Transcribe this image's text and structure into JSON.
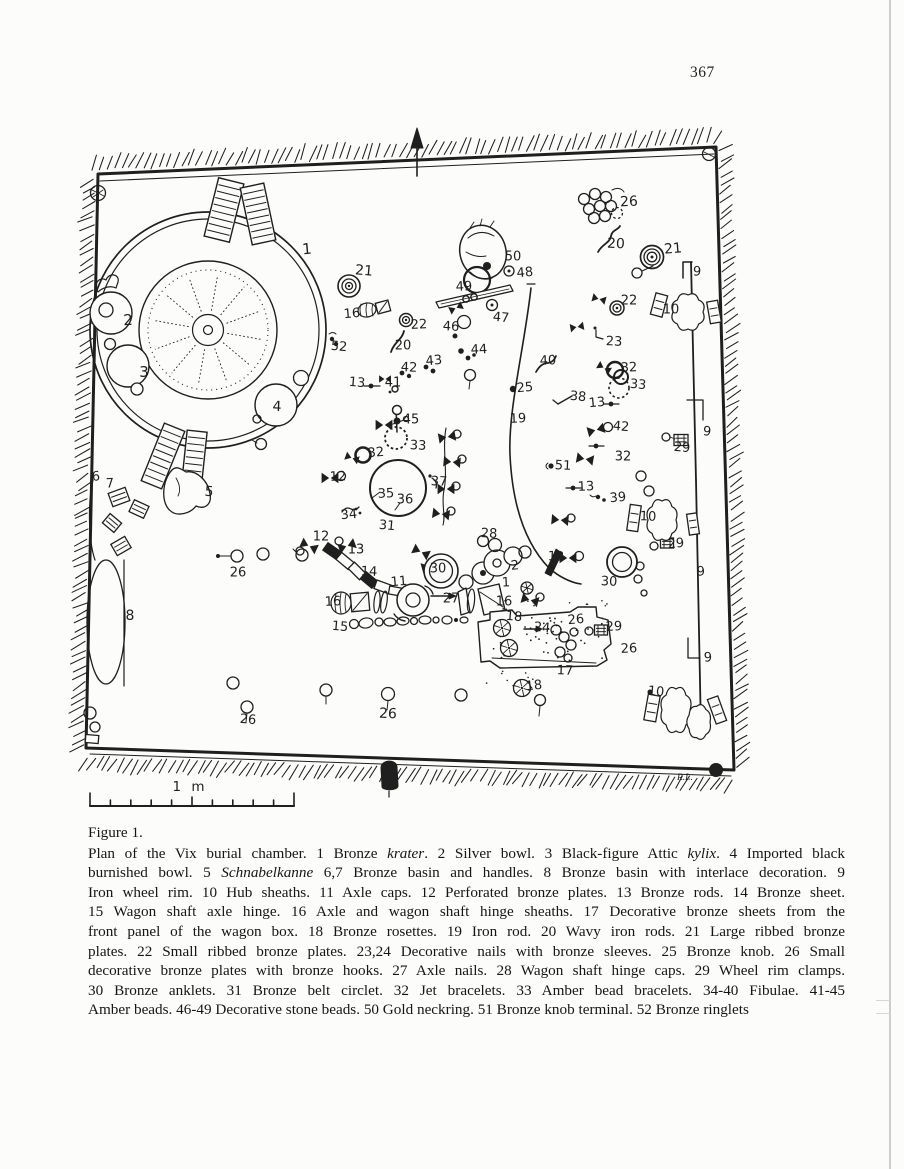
{
  "page": {
    "number": "367",
    "figure_label": "Figure 1.",
    "scale_label": "1 m",
    "signature": "R.L."
  },
  "colors": {
    "ink": "#1f1f1f",
    "paper": "#fcfcfa"
  },
  "caption": {
    "lines": [
      [
        {
          "t": "Plan of the Vix burial chamber. 1 Bronze "
        },
        {
          "t": "krater",
          "i": true
        },
        {
          "t": ". 2 Silver bowl. 3 Black-figure Attic "
        },
        {
          "t": "kylix",
          "i": true
        },
        {
          "t": ". 4 Imported black"
        }
      ],
      [
        {
          "t": "burnished bowl. 5 "
        },
        {
          "t": "Schnabelkanne",
          "i": true
        },
        {
          "t": " 6,7 Bronze basin and handles. 8 Bronze basin with interlace decoration. 9"
        }
      ],
      [
        {
          "t": "Iron wheel rim. 10 Hub sheaths. 11 Axle caps. 12 Perforated bronze plates. 13 Bronze rods. 14 Bronze sheet."
        }
      ],
      [
        {
          "t": "15 Wagon shaft axle hinge. 16 Axle and wagon shaft hinge sheaths. 17 Decorative bronze sheets from the"
        }
      ],
      [
        {
          "t": "front panel of the wagon box. 18 Bronze rosettes. 19 Iron rod. 20 Wavy iron rods. 21 Large ribbed bronze"
        }
      ],
      [
        {
          "t": "plates. 22 Small ribbed bronze plates. 23,24 Decorative nails with bronze sleeves. 25 Bronze knob. 26 Small"
        }
      ],
      [
        {
          "t": "decorative bronze plates with bronze hooks. 27 Axle nails. 28 Wagon shaft hinge caps. 29 Wheel rim clamps."
        }
      ],
      [
        {
          "t": "30 Bronze anklets. 31 Bronze belt circlet. 32 Jet bracelets. 33 Amber bead bracelets. 34-40 Fibulae. 41-45"
        }
      ],
      [
        {
          "t": "Amber beads. 46-49 Decorative stone beads. 50 Gold neckring. 51 Bronze knob terminal. 52 Bronze ringlets"
        }
      ]
    ]
  },
  "figure": {
    "labels": [
      {
        "t": "1",
        "x": 307,
        "y": 249,
        "s": 15
      },
      {
        "t": "2",
        "x": 128,
        "y": 320,
        "s": 15
      },
      {
        "t": "3",
        "x": 144,
        "y": 372,
        "s": 15
      },
      {
        "t": "4",
        "x": 277,
        "y": 407,
        "s": 14
      },
      {
        "t": "5",
        "x": 209,
        "y": 492,
        "s": 14
      },
      {
        "t": "6",
        "x": 96,
        "y": 477
      },
      {
        "t": "7",
        "x": 110,
        "y": 484
      },
      {
        "t": "8",
        "x": 130,
        "y": 616,
        "s": 14
      },
      {
        "t": "9",
        "x": 697,
        "y": 272
      },
      {
        "t": "9",
        "x": 707,
        "y": 432
      },
      {
        "t": "9",
        "x": 701,
        "y": 572
      },
      {
        "t": "9",
        "x": 708,
        "y": 658
      },
      {
        "t": "10",
        "x": 671,
        "y": 310
      },
      {
        "t": "10",
        "x": 648,
        "y": 517
      },
      {
        "t": "10",
        "x": 656,
        "y": 692
      },
      {
        "t": "11",
        "x": 399,
        "y": 582
      },
      {
        "t": "12",
        "x": 338,
        "y": 477
      },
      {
        "t": "12",
        "x": 321,
        "y": 537
      },
      {
        "t": "12",
        "x": 556,
        "y": 557
      },
      {
        "t": "13",
        "x": 357,
        "y": 383
      },
      {
        "t": "13",
        "x": 597,
        "y": 403
      },
      {
        "t": "13",
        "x": 586,
        "y": 487
      },
      {
        "t": "13",
        "x": 356,
        "y": 550
      },
      {
        "t": "14",
        "x": 369,
        "y": 572
      },
      {
        "t": "15",
        "x": 340,
        "y": 627
      },
      {
        "t": "16",
        "x": 352,
        "y": 314
      },
      {
        "t": "16",
        "x": 333,
        "y": 602
      },
      {
        "t": "16",
        "x": 504,
        "y": 602
      },
      {
        "t": "17",
        "x": 565,
        "y": 671
      },
      {
        "t": "18",
        "x": 514,
        "y": 617
      },
      {
        "t": "18",
        "x": 534,
        "y": 686
      },
      {
        "t": "19",
        "x": 518,
        "y": 419
      },
      {
        "t": "20",
        "x": 403,
        "y": 346
      },
      {
        "t": "20",
        "x": 616,
        "y": 244,
        "s": 14
      },
      {
        "t": "21",
        "x": 364,
        "y": 271,
        "s": 14
      },
      {
        "t": "21",
        "x": 673,
        "y": 249,
        "s": 14
      },
      {
        "t": "22",
        "x": 419,
        "y": 325
      },
      {
        "t": "22",
        "x": 629,
        "y": 301
      },
      {
        "t": "23",
        "x": 614,
        "y": 342
      },
      {
        "t": "24",
        "x": 542,
        "y": 628
      },
      {
        "t": "25",
        "x": 525,
        "y": 388
      },
      {
        "t": "26",
        "x": 629,
        "y": 202,
        "s": 14
      },
      {
        "t": "26",
        "x": 238,
        "y": 573
      },
      {
        "t": "26",
        "x": 388,
        "y": 714,
        "s": 14
      },
      {
        "t": "26",
        "x": 248,
        "y": 720
      },
      {
        "t": "26",
        "x": 576,
        "y": 620
      },
      {
        "t": "26",
        "x": 629,
        "y": 649
      },
      {
        "t": "27",
        "x": 451,
        "y": 599
      },
      {
        "t": "28",
        "x": 489,
        "y": 534
      },
      {
        "t": "29",
        "x": 682,
        "y": 448
      },
      {
        "t": "29",
        "x": 676,
        "y": 544
      },
      {
        "t": "29",
        "x": 614,
        "y": 627
      },
      {
        "t": "30",
        "x": 438,
        "y": 569
      },
      {
        "t": "30",
        "x": 609,
        "y": 582
      },
      {
        "t": "31",
        "x": 387,
        "y": 526
      },
      {
        "t": "32",
        "x": 376,
        "y": 453
      },
      {
        "t": "32",
        "x": 629,
        "y": 368
      },
      {
        "t": "32",
        "x": 623,
        "y": 457
      },
      {
        "t": "33",
        "x": 418,
        "y": 446
      },
      {
        "t": "33",
        "x": 638,
        "y": 385
      },
      {
        "t": "34",
        "x": 349,
        "y": 515
      },
      {
        "t": "35",
        "x": 386,
        "y": 494
      },
      {
        "t": "36",
        "x": 405,
        "y": 500
      },
      {
        "t": "37",
        "x": 439,
        "y": 482
      },
      {
        "t": "38",
        "x": 578,
        "y": 397
      },
      {
        "t": "39",
        "x": 618,
        "y": 498
      },
      {
        "t": "40",
        "x": 548,
        "y": 361
      },
      {
        "t": "41",
        "x": 393,
        "y": 383
      },
      {
        "t": "42",
        "x": 409,
        "y": 368
      },
      {
        "t": "42",
        "x": 621,
        "y": 427
      },
      {
        "t": "43",
        "x": 434,
        "y": 361
      },
      {
        "t": "44",
        "x": 479,
        "y": 350
      },
      {
        "t": "45",
        "x": 411,
        "y": 420
      },
      {
        "t": "46",
        "x": 451,
        "y": 327
      },
      {
        "t": "47",
        "x": 501,
        "y": 318
      },
      {
        "t": "48",
        "x": 525,
        "y": 273
      },
      {
        "t": "49",
        "x": 464,
        "y": 287
      },
      {
        "t": "50",
        "x": 513,
        "y": 257
      },
      {
        "t": "51",
        "x": 563,
        "y": 466
      },
      {
        "t": "52",
        "x": 339,
        "y": 347
      },
      {
        "t": "2",
        "x": 515,
        "y": 566
      },
      {
        "t": "1",
        "x": 506,
        "y": 583
      }
    ]
  }
}
